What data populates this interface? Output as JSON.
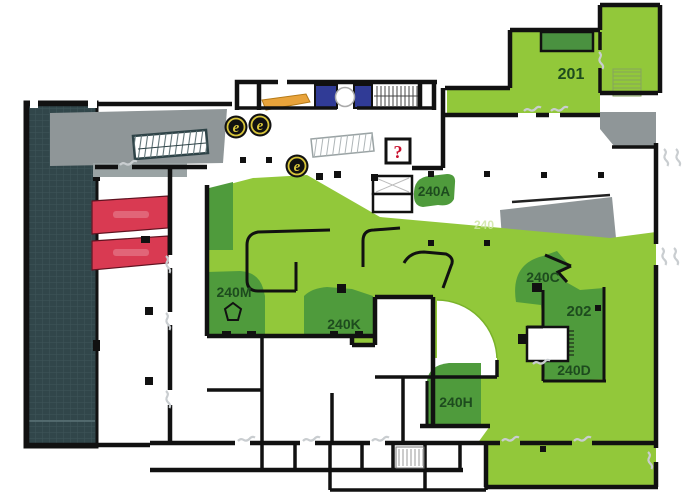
{
  "floor_plan": {
    "rooms": [
      {
        "id": "201",
        "label": "201"
      },
      {
        "id": "202",
        "label": "202"
      },
      {
        "id": "240A",
        "label": "240A"
      },
      {
        "id": "240C",
        "label": "240C"
      },
      {
        "id": "240D",
        "label": "240D"
      },
      {
        "id": "240H",
        "label": "240H"
      },
      {
        "id": "240K",
        "label": "240K"
      },
      {
        "id": "240M",
        "label": "240M"
      }
    ],
    "ghost_label": "240",
    "markers": {
      "escalators": [
        {
          "label": "e"
        },
        {
          "label": "e"
        },
        {
          "label": "e"
        }
      ],
      "info": {
        "label": "?"
      }
    },
    "colors": {
      "available_green": "#92C83A",
      "room_dark_green": "#4F9B3C",
      "inner_room_green": "#4A9140",
      "label_green": "#1D4B1E",
      "unavailable_red": "#D93A52",
      "terrace_teal": "#31464A",
      "overlook_gray": "#8F9698",
      "escalator_orange": "#E8A33B",
      "elevator_blue": "#303B96",
      "wall_black": "#111111",
      "marker_yellow": "#D8C53A",
      "info_red": "#C8102E"
    }
  }
}
